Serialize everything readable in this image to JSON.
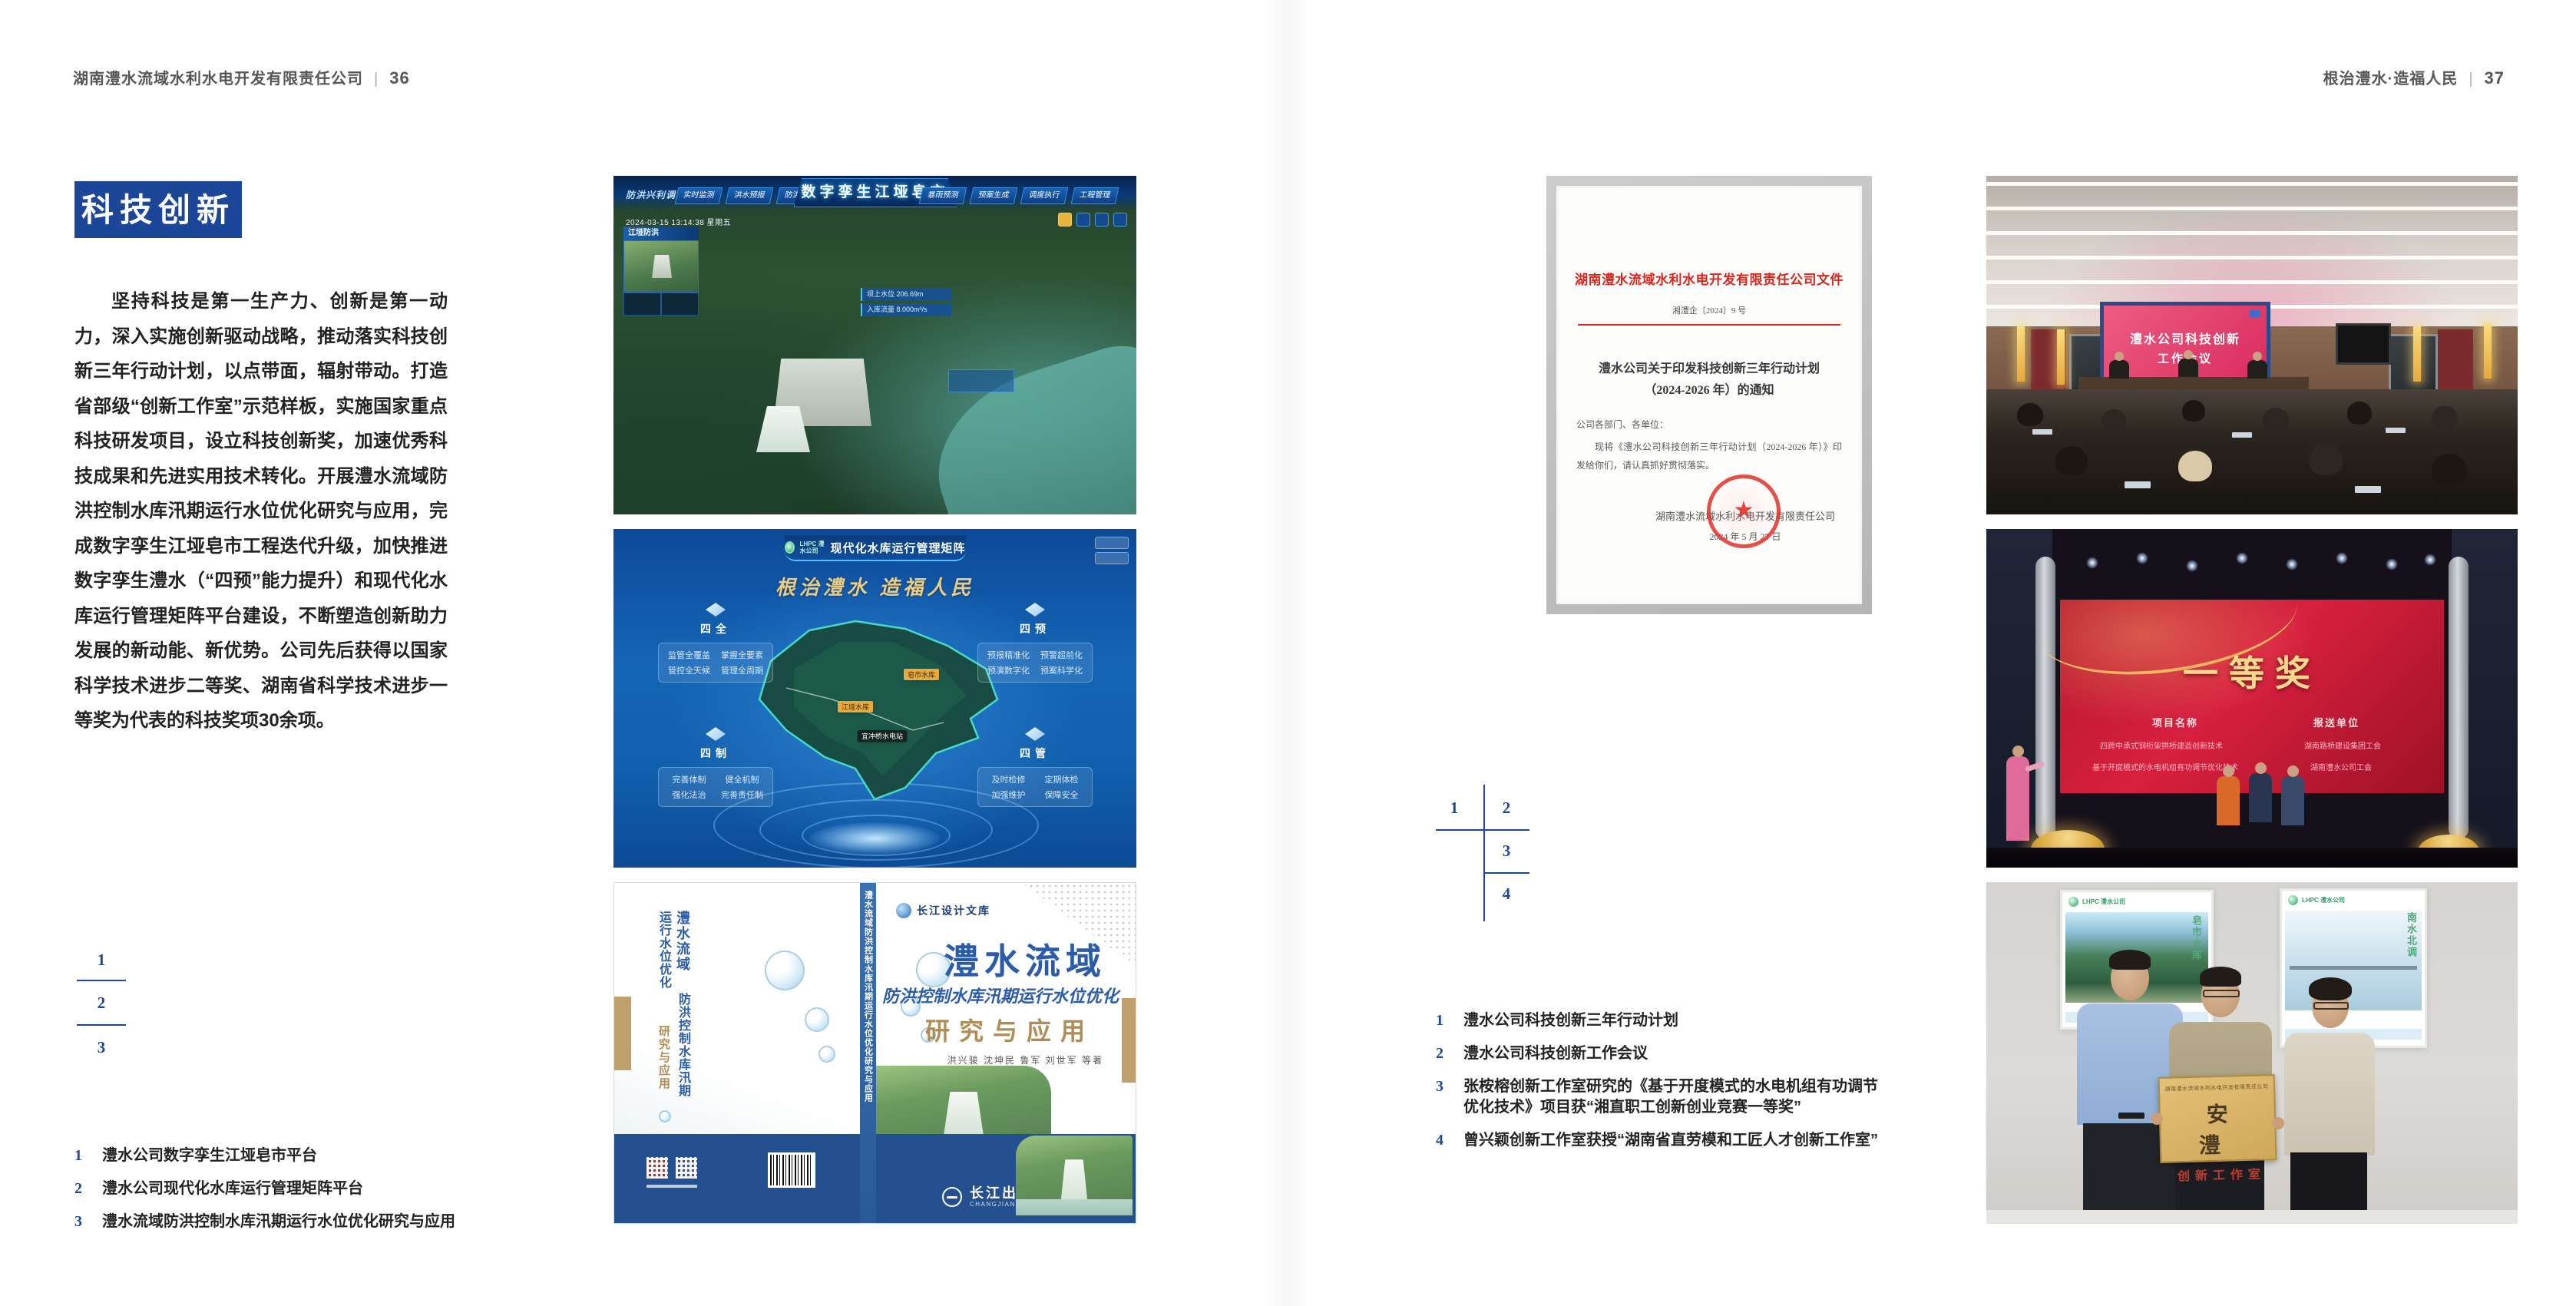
{
  "colors": {
    "brand_blue": "#1c4697",
    "doc_red": "#d9251c",
    "gold": "#e9cb82"
  },
  "page_left": {
    "header": {
      "company": "湖南澧水流域水利水电开发有限责任公司",
      "divider": "|",
      "page_number": "36"
    },
    "badge": "科技创新",
    "paragraph": "坚持科技是第一生产力、创新是第一动力，深入实施创新驱动战略，推动落实科技创新三年行动计划，以点带面，辐射带动。打造省部级“创新工作室”示范样板，实施国家重点科技研发项目，设立科技创新奖，加速优秀科技成果和先进实用技术转化。开展澧水流域防洪控制水库汛期运行水位优化研究与应用，完成数字孪生江垭皂市工程迭代升级，加快推进数字孪生澧水（“四预”能力提升）和现代化水库运行管理矩阵平台建设，不断塑造创新助力发展的新动能、新优势。公司先后获得以国家科学技术进步二等奖、湖南省科学技术进步一等奖为代表的科技奖项30余项。",
    "figure_keys": [
      "1",
      "2",
      "3"
    ],
    "captions": [
      {
        "num": "1",
        "text": "澧水公司数字孪生江垭皂市平台"
      },
      {
        "num": "2",
        "text": "澧水公司现代化水库运行管理矩阵平台"
      },
      {
        "num": "3",
        "text": "澧水流域防洪控制水库汛期运行水位优化研究与应用"
      }
    ]
  },
  "page_right": {
    "header": {
      "title": "根治澧水·造福人民",
      "divider": "|",
      "page_number": "37"
    },
    "figure_keys": [
      "1",
      "2",
      "3",
      "4"
    ],
    "captions": [
      {
        "num": "1",
        "text": "澧水公司科技创新三年行动计划"
      },
      {
        "num": "2",
        "text": "澧水公司科技创新工作会议"
      },
      {
        "num": "3",
        "text": "张桉榕创新工作室研究的《基于开度模式的水电机组有功调节优化技术》项目获“湘直职工创新创业竞赛一等奖”"
      },
      {
        "num": "4",
        "text": "曾兴颖创新工作室获授“湖南省直劳模和工匠人才创新工作室”"
      }
    ]
  },
  "figure_dashboard": {
    "title": "数字孪生江垭皂市",
    "scene_label": "防洪兴利调度",
    "tabs_left": [
      "实时监测",
      "洪水预报",
      "防洪预警"
    ],
    "tabs_right": [
      "暴雨预测",
      "预案生成",
      "调度执行",
      "工程管理"
    ],
    "datetime": "2024-03-15 13:14:38 星期五",
    "panel_title": "江垭防洪",
    "stat1": "坝上水位 206.69m",
    "stat2": "入库流量 8.000m³/s"
  },
  "figure_matrix": {
    "brand": "LHPC 澧水公司",
    "title": "现代化水库运行管理矩阵",
    "slogan": "根治澧水 造福人民",
    "corners": [
      {
        "title": "四全",
        "items": [
          "监管全覆盖",
          "掌握全要素",
          "管控全天候",
          "管理全周期"
        ]
      },
      {
        "title": "四预",
        "items": [
          "预报精准化",
          "预警超前化",
          "预演数字化",
          "预案科学化"
        ]
      },
      {
        "title": "四制",
        "items": [
          "完善体制",
          "健全机制",
          "强化法治",
          "完善责任制"
        ]
      },
      {
        "title": "四管",
        "items": [
          "及时检修",
          "定期体检",
          "加强维护",
          "保障安全"
        ]
      }
    ],
    "markers": [
      "皂市水库",
      "江垭水库",
      "宜冲桥水电站"
    ]
  },
  "figure_book": {
    "series": "长江设计文库",
    "title_region": "澧水流域",
    "title_sub": "防洪控制水库汛期运行水位优化",
    "title_tail": "研究与应用",
    "authors": "洪兴骏 沈坤民 鲁军 刘世军 等著",
    "spine_title": "澧水流域防洪控制水库汛期运行水位优化研究与应用",
    "publisher": "长江出版社",
    "publisher_en": "CHANGJIANG PRESS"
  },
  "figure_document": {
    "org_title": "湖南澧水流域水利水电开发有限责任公司文件",
    "doc_no": "湘澧企〔2024〕9 号",
    "title_line1": "澧水公司关于印发科技创新三年行动计划",
    "title_line2": "（2024-2026 年）的通知",
    "salutation": "公司各部门、各单位：",
    "body": "现将《澧水公司科技创新三年行动计划（2024-2026 年）》印发给你们，请认真抓好贯彻落实。",
    "signer": "湖南澧水流域水利水电开发有限责任公司",
    "date": "2024 年 5 月 27 日",
    "seal_star": "★"
  },
  "figure_meeting": {
    "screen_line1": "澧水公司科技创新",
    "screen_line2": "工作会议"
  },
  "figure_award": {
    "prize": "一等奖",
    "col1_header": "项目名称",
    "col2_header": "报送单位",
    "col1_rows": [
      "四跨中承式钢桁架拱桥建造创新技术",
      "基于开度模式的水电机组有功调节优化技术"
    ],
    "col2_rows": [
      "湖南路桥建设集团工会",
      "湖南澧水公司工会"
    ]
  },
  "figure_group": {
    "plaque_org": "湖南澧水流域水利水电开发有限责任公司",
    "plaque_main": "安 澧",
    "plaque_sub": "创新工作室",
    "poster_left_brand": "LHPC 澧水公司",
    "poster_left_caption": "皂市水库",
    "poster_right_brand": "LHPC 澧水公司",
    "poster_right_caption": "南水北调"
  }
}
